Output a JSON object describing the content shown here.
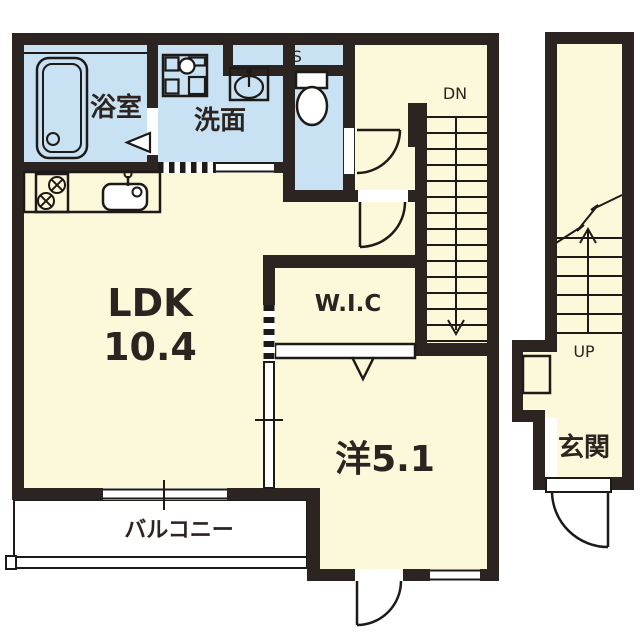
{
  "floorplan": {
    "labels": {
      "bathroom": "浴室",
      "washroom": "洗面",
      "pipe_space": "PS",
      "stairs_down": "DN",
      "ldk_name": "LDK",
      "ldk_area": "10.4",
      "wic": "W.I.C",
      "western_room": "洋5.1",
      "balcony": "バルコニー",
      "stairs_up": "UP",
      "entrance": "玄関"
    },
    "colors": {
      "wall": "#2b2420",
      "room_floor": "#fcf8da",
      "wet_area": "#c9e2f3",
      "openings": "#ffffff",
      "line": "#1d1a17"
    }
  }
}
